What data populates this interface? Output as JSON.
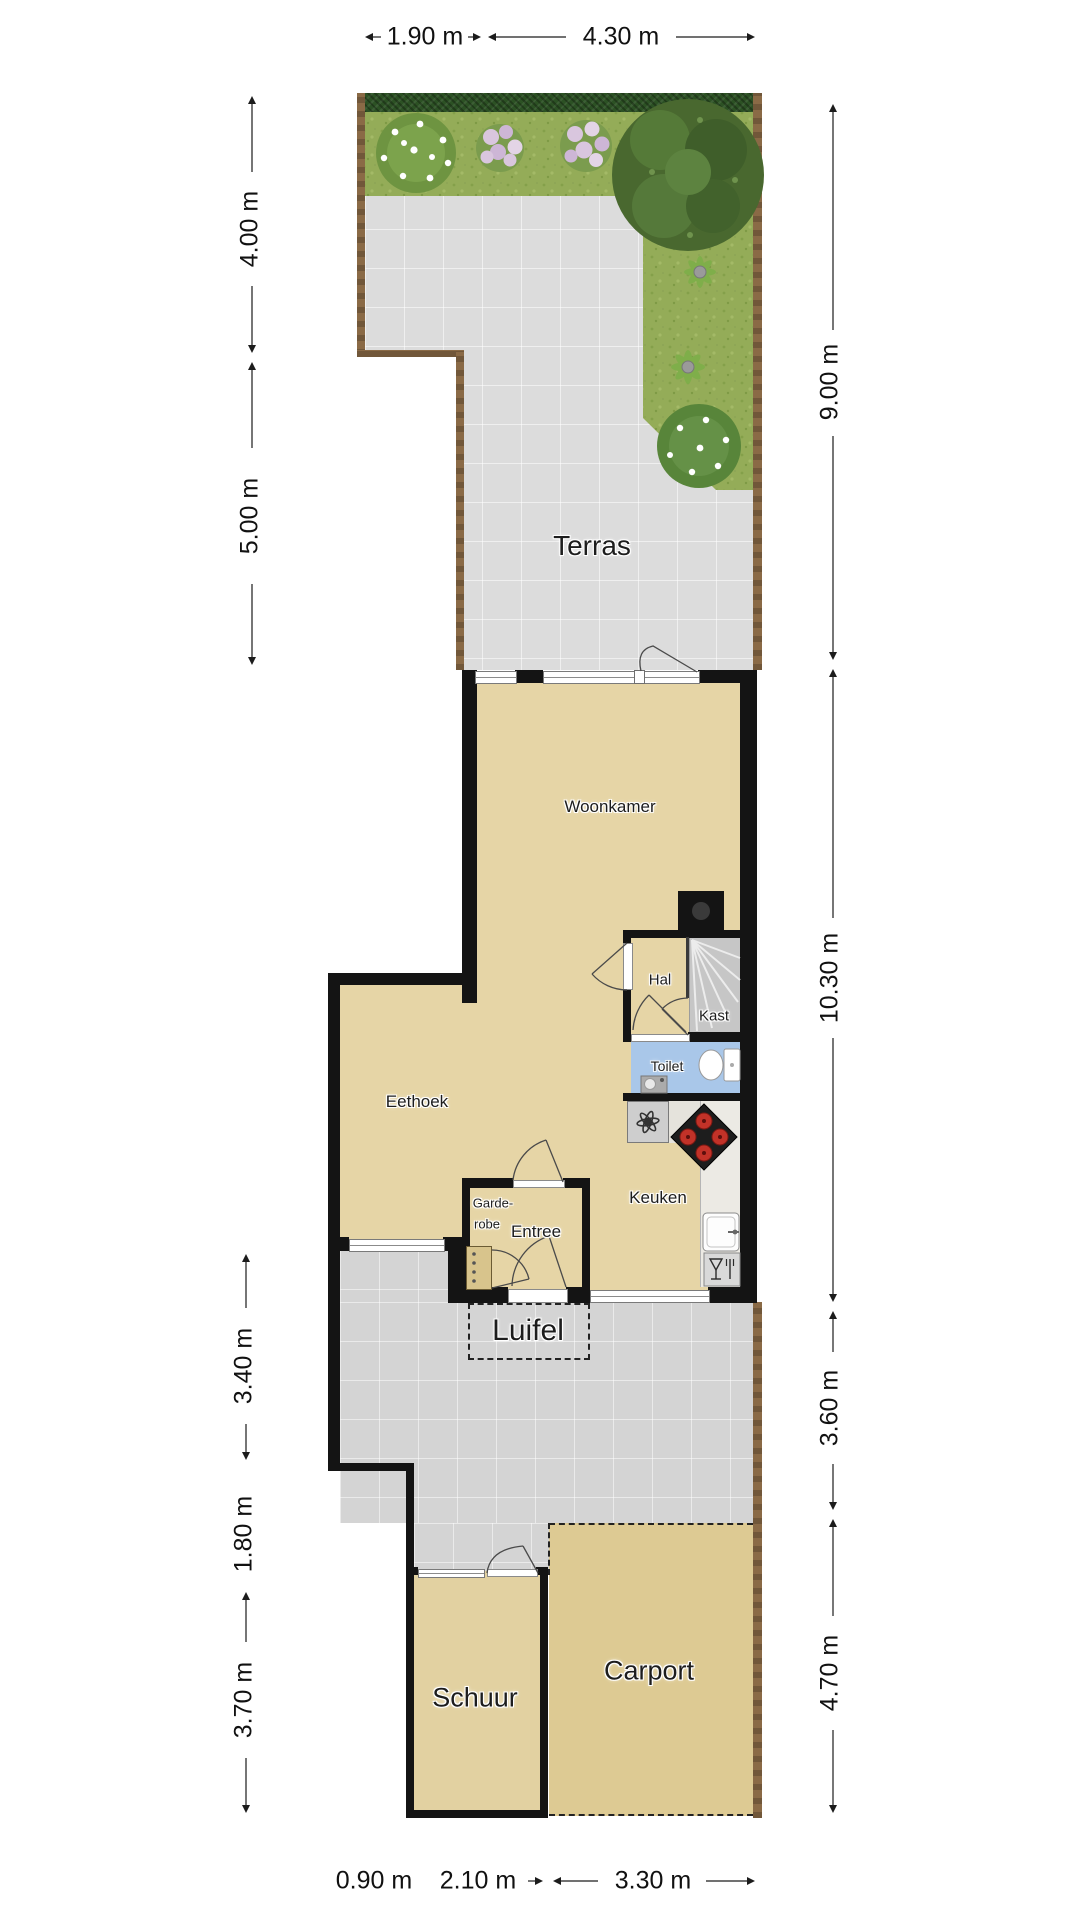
{
  "plan_title": "Floor plan with garden, house, shed and carport",
  "rooms": {
    "terras": "Terras",
    "woonkamer": "Woonkamer",
    "hal": "Hal",
    "kast": "Kast",
    "toilet": "Toilet",
    "eethoek": "Eethoek",
    "garderobe_line1": "Garde-",
    "garderobe_line2": "robe",
    "entree": "Entree",
    "keuken": "Keuken",
    "luifel": "Luifel",
    "schuur": "Schuur",
    "carport": "Carport"
  },
  "dimensions": {
    "top": [
      {
        "label": "1.90 m"
      },
      {
        "label": "4.30 m"
      }
    ],
    "left": [
      {
        "label": "4.00 m"
      },
      {
        "label": "5.00 m"
      },
      {
        "label": "3.40 m"
      },
      {
        "label": "1.80 m"
      },
      {
        "label": "3.70 m"
      }
    ],
    "right": [
      {
        "label": "9.00 m"
      },
      {
        "label": "10.30 m"
      },
      {
        "label": "3.60 m"
      },
      {
        "label": "4.70 m"
      }
    ],
    "bottom": [
      {
        "label": "0.90 m"
      },
      {
        "label": "2.10 m"
      },
      {
        "label": "3.30 m"
      }
    ]
  },
  "colors": {
    "wall": "#141414",
    "floor": "#e6d5a6",
    "terrace": "#dcdcdc",
    "driveway": "#d4d4d4",
    "grass": "#94ac58",
    "hedge": "#2c5124",
    "fence": "#8a6a46",
    "toilet_floor": "#a9c7e9",
    "stairs": "#c6c6c6",
    "carport_floor": "#ddca93",
    "burner_red": "#c23228"
  },
  "icons": {
    "tree": "tree-icon",
    "flower_bush": "flower-bush-icon",
    "pink_flowers": "pink-flowers-icon",
    "fern": "fern-icon",
    "stove": "stove-icon",
    "kitchen_sink": "kitchen-sink-icon",
    "dishwasher": "dishwasher-icon",
    "extractor_fan": "extractor-fan-icon",
    "toilet_fixture": "toilet-icon",
    "hand_basin": "hand-basin-icon",
    "stairs": "stairs-icon",
    "chimney": "chimney-icon",
    "wardrobe": "wardrobe-icon",
    "door_swing": "door-swing-icon"
  }
}
